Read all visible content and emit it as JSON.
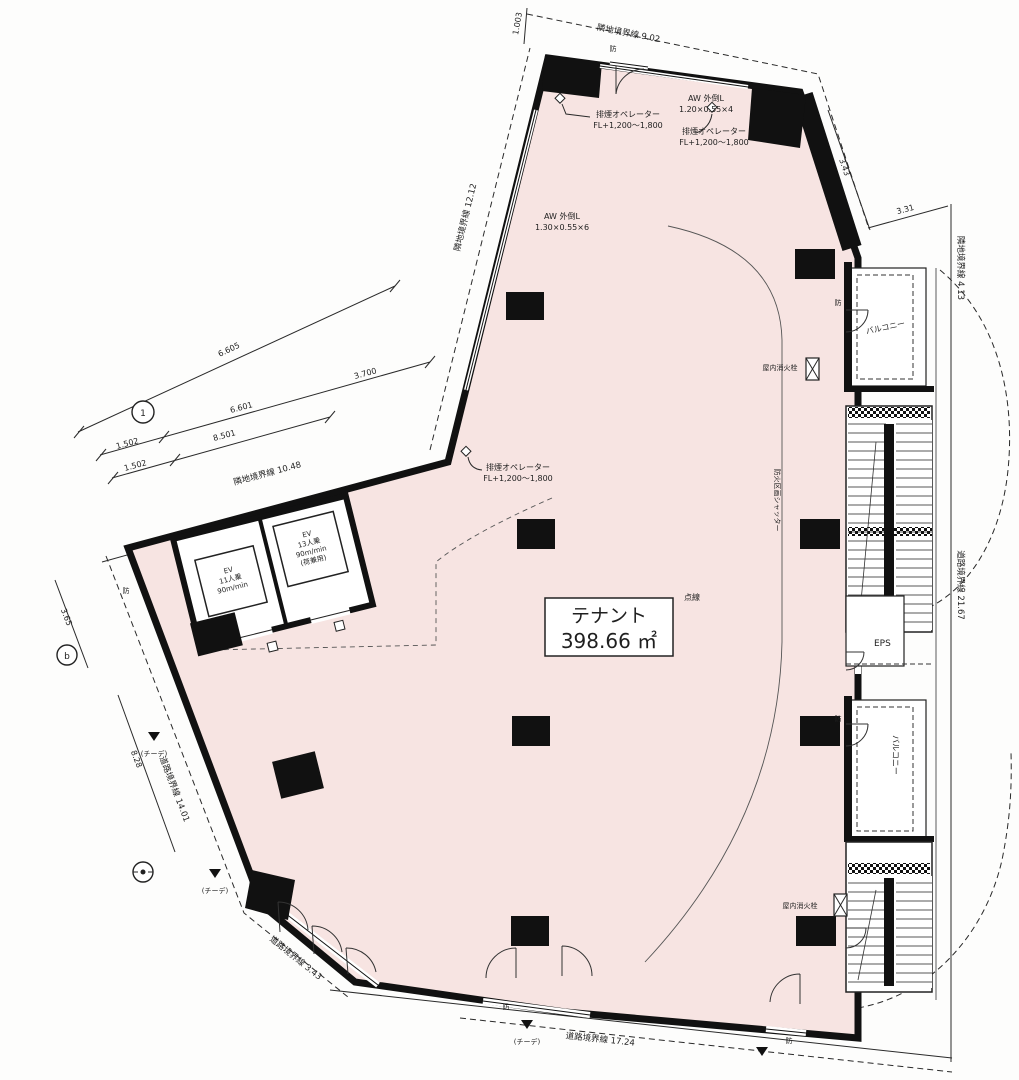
{
  "drawing": {
    "type": "floor-plan",
    "colors": {
      "plan_fill": "#f7e4e2",
      "line": "#1a1a1a",
      "paper": "#fdfdfc"
    }
  },
  "tenant": {
    "name": "テナント",
    "area": "398.66 ㎡",
    "note": "点線"
  },
  "labels": {
    "boundary_top": "隣地境界線 9.02",
    "boundary_upper_left": "隣地境界線 12.12",
    "boundary_left": "隣地境界線 10.48",
    "boundary_top_right": "隣地境界線 4.13",
    "boundary_right": "道路境界線 21.67",
    "boundary_bottom": "道路境界線 17.24",
    "boundary_lower_left": "道路境界線 14.01",
    "boundary_bottom_left": "道路境界線 3.43"
  },
  "dims": {
    "a": "6.605",
    "b": "3.700",
    "c": "6.601",
    "d": "8.501",
    "e": "1.502",
    "f": "1.502",
    "g": "8.28",
    "h": "3.65",
    "i": "3.31",
    "j": "3.43",
    "k": "1.003"
  },
  "win": {
    "aw1": "AW 外倒L",
    "aw1s": "1.20×0.55×4",
    "aw2": "AW 外倒L",
    "aw2s": "1.30×0.55×6",
    "smoke": "排煙オペレーター",
    "smokefl": "FL+1,200〜1,800"
  },
  "ev": {
    "e1a": "EV",
    "e1b": "11人乗",
    "e1c": "90m/min",
    "e2a": "EV",
    "e2b": "13人乗",
    "e2c": "90m/min",
    "e2d": "(荷兼用)"
  },
  "rooms": {
    "eps": "EPS",
    "balcony": "バルコニー",
    "hydrant": "屋内消火栓",
    "partition": "防火区画シャッター"
  },
  "marks": {
    "fire": "防",
    "teede": "(チーデ)",
    "g1": "1",
    "gb": "b"
  }
}
